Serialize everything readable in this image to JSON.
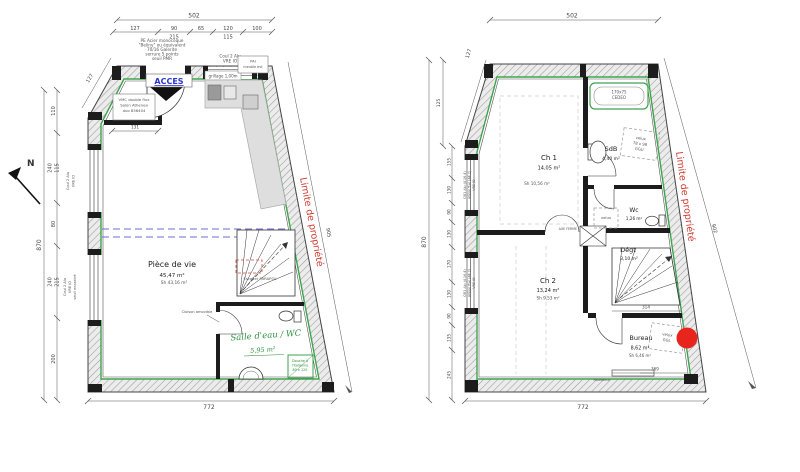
{
  "colors": {
    "property_line_red": "#d03a2f",
    "marker_red": "#e8251d",
    "access_blue": "#2934d0",
    "annotation_green": "#2f8f3f",
    "insulation_green": "#3fa34d",
    "guide_blue": "#6b6bd6"
  },
  "north_label": "N",
  "left_plan": {
    "dims": {
      "top_total": "502",
      "top_row1": [
        "127",
        "90",
        "65",
        "120",
        "100"
      ],
      "top_row2": [
        "215",
        "115"
      ],
      "left_total": "870",
      "left_segs": [
        "110",
        "240",
        "115",
        "80",
        "240",
        "215",
        "200"
      ],
      "chamfer": "127",
      "bottom_total": "772",
      "slant": "905",
      "closet_width": "131"
    },
    "notes": {
      "door_spec": [
        "PE Acier monocoque",
        "\"Beliny\" ou équivalent",
        "70/16 Galerite",
        "serrure 5 points",
        "seuil PMR"
      ],
      "access": "ACCES",
      "window_top": [
        "Coul 2 Alu",
        "VRE IO"
      ],
      "pai": [
        "PAI",
        "meuble evt"
      ],
      "grillage": "grillage 1,00m",
      "vmc": [
        "VMC double flux",
        "Salon Athenea",
        "duo 856404"
      ],
      "window_left_1": [
        "Coul 2 Alu",
        "VRE IO"
      ],
      "window_left_2": [
        "Coul 2 Alu",
        "VRE IO",
        "seuil encastré"
      ],
      "stair": "Escalier PARAPOL",
      "cloison": "Cloison amovible",
      "property_line": "Limite de propriété"
    },
    "rooms": {
      "living": {
        "name": "Pièce de vie",
        "area": "45,47 m²",
        "sh": "Sh 43,16 m²"
      },
      "bathroom": {
        "name": "Salle d'eau / WC",
        "area": "5,95 m²"
      },
      "douche": [
        "Douche à",
        "l'italienne",
        "80 x 120"
      ]
    }
  },
  "right_plan": {
    "dims": {
      "top_total": "502",
      "chamfer": "127",
      "left_upper": "125",
      "left_total": "870",
      "left_segs": [
        "155",
        "130",
        "90",
        "130",
        "170",
        "130",
        "90",
        "135",
        "245"
      ],
      "bottom_total": "772",
      "slant": "902",
      "bureau_width": "314",
      "bureau_bottom": "369"
    },
    "notes": {
      "window_left_1": [
        "OB1 Alu (4.16.4)",
        "Allège fixe (44.2)",
        "VRE IO"
      ],
      "window_left_2": [
        "OB1 Alu (4.16.4)",
        "Allège fixe (44.2)",
        "VRE IO"
      ],
      "tub": [
        "170x75",
        "CEDEO"
      ],
      "velux_sdb": [
        "velux",
        "78 x 98",
        "GGU"
      ],
      "velux_hall": "velux",
      "velux_bureau": [
        "velux",
        "GGL"
      ],
      "axe_ferme": "AXE FERME",
      "radiator": "Radiateur",
      "property_line": "Limite de propriété"
    },
    "rooms": {
      "ch1": {
        "name": "Ch 1",
        "area": "14,05 m²",
        "sh": "Sh 10,56 m²"
      },
      "sdb": {
        "name": "SdB",
        "area": "4,40 m²"
      },
      "wc": {
        "name": "Wc",
        "area": "1,26 m²"
      },
      "degt": {
        "name": "Dégt",
        "area": "3,10 m²"
      },
      "ch2": {
        "name": "Ch 2",
        "area": "13,24 m²",
        "sh": "Sh 9,53 m²"
      },
      "bureau": {
        "name": "Bureau",
        "area": "8,62 m²",
        "sh": "Sh 6,46 m²"
      }
    }
  }
}
